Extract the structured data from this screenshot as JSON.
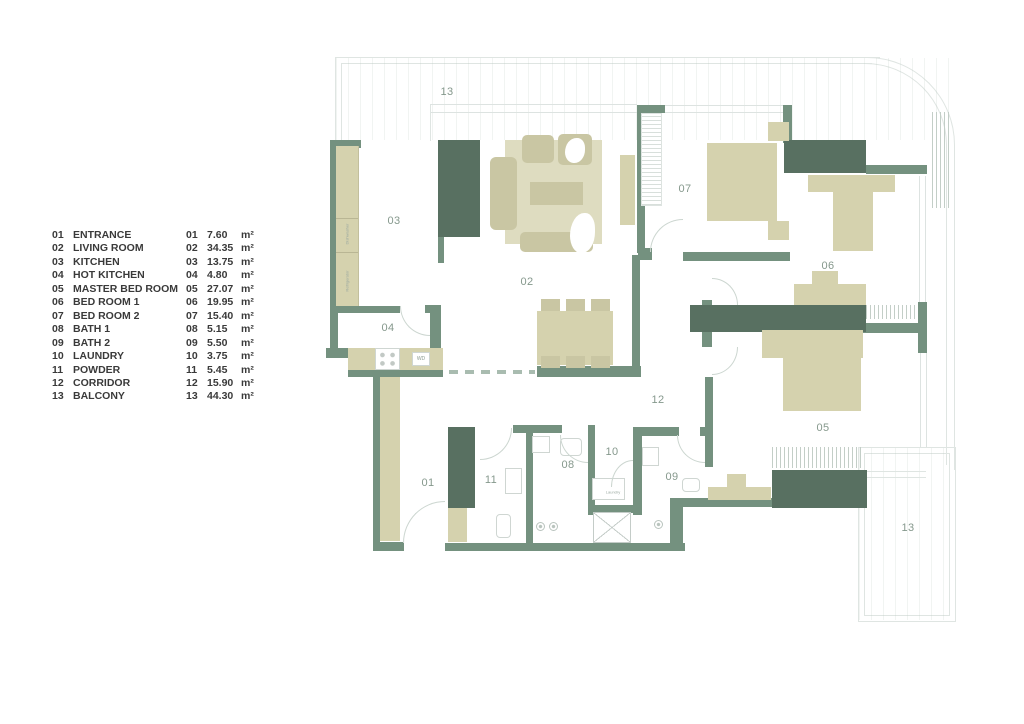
{
  "legend": {
    "area_unit": "m²",
    "rooms": [
      {
        "num": "01",
        "name": "ENTRANCE",
        "area": "7.60"
      },
      {
        "num": "02",
        "name": "LIVING ROOM",
        "area": "34.35"
      },
      {
        "num": "03",
        "name": "KITCHEN",
        "area": "13.75"
      },
      {
        "num": "04",
        "name": "HOT KITCHEN",
        "area": "4.80"
      },
      {
        "num": "05",
        "name": "MASTER BED ROOM",
        "area": "27.07"
      },
      {
        "num": "06",
        "name": "BED ROOM 1",
        "area": "19.95"
      },
      {
        "num": "07",
        "name": "BED ROOM 2",
        "area": "15.40"
      },
      {
        "num": "08",
        "name": "BATH 1",
        "area": "5.15"
      },
      {
        "num": "09",
        "name": "BATH 2",
        "area": "5.50"
      },
      {
        "num": "10",
        "name": "LAUNDRY",
        "area": "3.75"
      },
      {
        "num": "11",
        "name": "POWDER",
        "area": "5.45"
      },
      {
        "num": "12",
        "name": "CORRIDOR",
        "area": "15.90"
      },
      {
        "num": "13",
        "name": "BALCONY",
        "area": "44.30"
      }
    ]
  },
  "plan": {
    "room_labels": {
      "balcony_top": "13",
      "kitchen": "03",
      "living": "02",
      "bedroom2": "07",
      "bedroom1": "06",
      "hot_kitchen": "04",
      "corridor": "12",
      "entrance": "01",
      "powder": "11",
      "bath1": "08",
      "laundry": "10",
      "bath2": "09",
      "master": "05",
      "balcony_bottom": "13"
    },
    "small_labels": {
      "washer_dryer": "WD",
      "laundry": "Laundry",
      "refrigerator": "Refrigerator",
      "dishwasher": "Dishwasher"
    },
    "colors": {
      "wall": "#74917f",
      "wall_dark": "#587061",
      "furniture": "#d5d2ae",
      "rug": "#dedcc0",
      "outline": "#dfe5e2",
      "room_label": "#85988c",
      "legend_text": "#3a3a3a"
    }
  }
}
